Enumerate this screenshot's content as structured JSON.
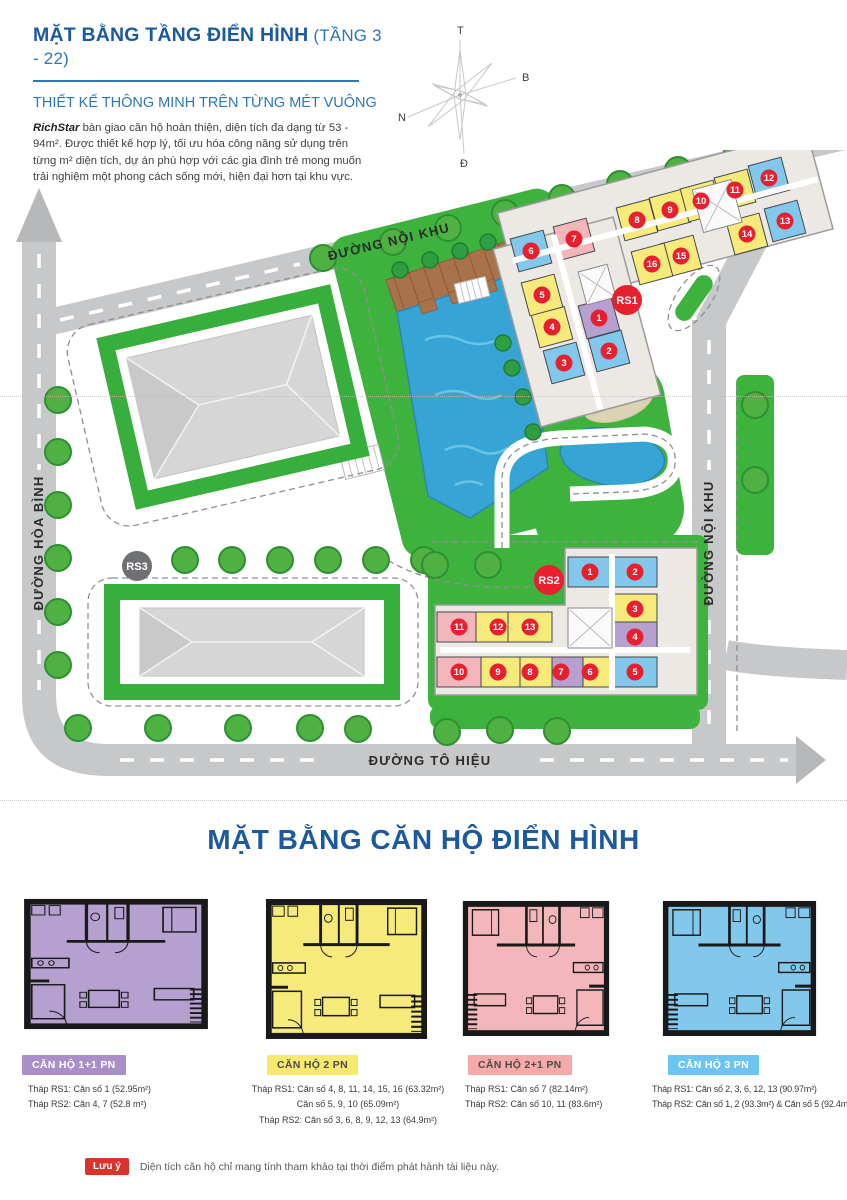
{
  "header": {
    "title_main": "MẶT BẰNG TẦNG ĐIỂN HÌNH",
    "title_suffix": " (TẦNG 3 - 22)",
    "subtitle": "THIẾT KẾ THÔNG MINH TRÊN TỪNG MÉT VUÔNG",
    "intro_brand": "RichStar",
    "intro_text": " bàn giao căn hộ hoàn thiện, diện tích đa dạng từ 53 - 94m². Được thiết kế hợp lý, tối ưu hóa công năng sử dụng trên từng m² diện tích, dự án phù hợp với các gia đình trẻ mong muốn trải nghiệm một phong cách sống mới, hiện đại hơn tại khu vực."
  },
  "compass": {
    "top": "T",
    "right": "B",
    "left": "N",
    "bottom": "Đ"
  },
  "site": {
    "roads": {
      "top": "ĐƯỜNG NỘI KHU",
      "left": "ĐƯỜNG HÒA BÌNH",
      "right": "ĐƯỜNG NỘI KHU",
      "bottom": "ĐƯỜNG TÔ HIỆU"
    },
    "towers": {
      "rs1": "RS1",
      "rs2": "RS2",
      "rs3": "RS3"
    },
    "rs1": {
      "units": [
        {
          "n": "1",
          "c": "P",
          "x": 599,
          "y": 168
        },
        {
          "n": "2",
          "c": "B",
          "x": 609,
          "y": 201
        },
        {
          "n": "3",
          "c": "B",
          "x": 564,
          "y": 213
        },
        {
          "n": "4",
          "c": "Y",
          "x": 552,
          "y": 177
        },
        {
          "n": "5",
          "c": "Y",
          "x": 542,
          "y": 145
        },
        {
          "n": "6",
          "c": "B",
          "x": 531,
          "y": 101
        },
        {
          "n": "7",
          "c": "R",
          "x": 574,
          "y": 89
        },
        {
          "n": "8",
          "c": "Y",
          "x": 637,
          "y": 70
        },
        {
          "n": "9",
          "c": "Y",
          "x": 670,
          "y": 60
        },
        {
          "n": "10",
          "c": "Y",
          "x": 701,
          "y": 51
        },
        {
          "n": "11",
          "c": "Y",
          "x": 735,
          "y": 40
        },
        {
          "n": "12",
          "c": "B",
          "x": 769,
          "y": 28
        },
        {
          "n": "13",
          "c": "B",
          "x": 785,
          "y": 71
        },
        {
          "n": "14",
          "c": "Y",
          "x": 747,
          "y": 84
        },
        {
          "n": "15",
          "c": "Y",
          "x": 681,
          "y": 106
        },
        {
          "n": "16",
          "c": "Y",
          "x": 652,
          "y": 114
        }
      ]
    },
    "rs2": {
      "units": [
        {
          "n": "1",
          "c": "B",
          "x": 590,
          "y": 422
        },
        {
          "n": "2",
          "c": "B",
          "x": 635,
          "y": 422
        },
        {
          "n": "3",
          "c": "Y",
          "x": 635,
          "y": 459
        },
        {
          "n": "4",
          "c": "P",
          "x": 635,
          "y": 487
        },
        {
          "n": "5",
          "c": "B",
          "x": 635,
          "y": 522
        },
        {
          "n": "6",
          "c": "Y",
          "x": 590,
          "y": 522
        },
        {
          "n": "7",
          "c": "P",
          "x": 561,
          "y": 522
        },
        {
          "n": "8",
          "c": "Y",
          "x": 530,
          "y": 522
        },
        {
          "n": "9",
          "c": "Y",
          "x": 498,
          "y": 522
        },
        {
          "n": "10",
          "c": "R",
          "x": 459,
          "y": 522
        },
        {
          "n": "11",
          "c": "R",
          "x": 459,
          "y": 477
        },
        {
          "n": "12",
          "c": "Y",
          "x": 498,
          "y": 477
        },
        {
          "n": "13",
          "c": "Y",
          "x": 530,
          "y": 477
        }
      ]
    },
    "trees": [
      [
        323,
        108
      ],
      [
        393,
        92
      ],
      [
        448,
        78
      ],
      [
        505,
        63
      ],
      [
        562,
        48
      ],
      [
        620,
        34
      ],
      [
        678,
        20
      ],
      [
        736,
        6
      ],
      [
        58,
        250
      ],
      [
        58,
        302
      ],
      [
        58,
        355
      ],
      [
        58,
        408
      ],
      [
        58,
        462
      ],
      [
        58,
        515
      ],
      [
        185,
        410
      ],
      [
        232,
        410
      ],
      [
        280,
        410
      ],
      [
        328,
        410
      ],
      [
        376,
        410
      ],
      [
        424,
        410
      ],
      [
        78,
        578
      ],
      [
        158,
        578
      ],
      [
        238,
        578
      ],
      [
        310,
        578
      ],
      [
        358,
        579
      ],
      [
        447,
        582
      ],
      [
        500,
        580
      ],
      [
        557,
        581
      ],
      [
        435,
        415
      ],
      [
        488,
        415
      ],
      [
        755,
        255
      ],
      [
        755,
        330
      ]
    ],
    "palms": [
      [
        503,
        193
      ],
      [
        512,
        218
      ],
      [
        523,
        247
      ],
      [
        533,
        282
      ],
      [
        400,
        120
      ],
      [
        430,
        110
      ],
      [
        460,
        101
      ],
      [
        488,
        92
      ]
    ]
  },
  "section2": {
    "title": "MẶT BẰNG CĂN HỘ ĐIỂN HÌNH"
  },
  "cards": [
    {
      "badge": "CĂN HỘ 1+1 PN",
      "badge_bg": "#a98fc7",
      "badge_fg": "#ffffff",
      "plan_fill": "#b5a0d0",
      "lines": [
        "Tháp RS1: Căn số 1 (52.95m²)",
        "Tháp RS2: Căn 4, 7 (52.8 m²)"
      ]
    },
    {
      "badge": "CĂN HỘ 2 PN",
      "badge_bg": "#f6e96e",
      "badge_fg": "#4a4a4a",
      "plan_fill": "#f6ea7b",
      "lines": [
        "Tháp RS1: Căn số 4, 8, 11, 14, 15, 16 (63.32m²)",
        "Căn số 5, 9, 10 (65.09m²)",
        "Tháp RS2: Căn số 3, 6, 8, 9, 12, 13 (64.9m²)"
      ]
    },
    {
      "badge": "CĂN HỘ 2+1 PN",
      "badge_bg": "#f5a9a9",
      "badge_fg": "#4a4a4a",
      "plan_fill": "#f3b6ba",
      "lines": [
        "Tháp RS1: Căn số 7 (82.14m²)",
        "Tháp RS2: Căn số 10, 11 (83.6m²)"
      ]
    },
    {
      "badge": "CĂN HỘ 3 PN",
      "badge_bg": "#6cc4f0",
      "badge_fg": "#ffffff",
      "plan_fill": "#82c8ec",
      "lines": [
        "Tháp RS1: Căn số 2, 3, 6, 12, 13 (90.97m²)",
        "Tháp RS2: Căn số 1, 2 (93.3m²) & Căn số 5 (92.4m²)"
      ]
    }
  ],
  "footer": {
    "badge": "Lưu ý",
    "text": "Diện tích căn hộ chỉ mang tính tham khảo tại thời điểm phát hành tài liệu này."
  },
  "colors": {
    "accent_dark": "#1b5a9e",
    "accent": "#2f76b5",
    "marker_red": "#e7202f",
    "tower_gray": "#6f7073",
    "road": "#c7c8ca",
    "grass": "#3db33d",
    "pool": "#36a5d6",
    "deck": "#a9724a",
    "sand": "#dcd2b4",
    "note_red": "#d8342c",
    "unit": {
      "P": "#b5a0d0",
      "Y": "#f6ea7b",
      "B": "#82c8ec",
      "R": "#f3b6ba"
    }
  }
}
